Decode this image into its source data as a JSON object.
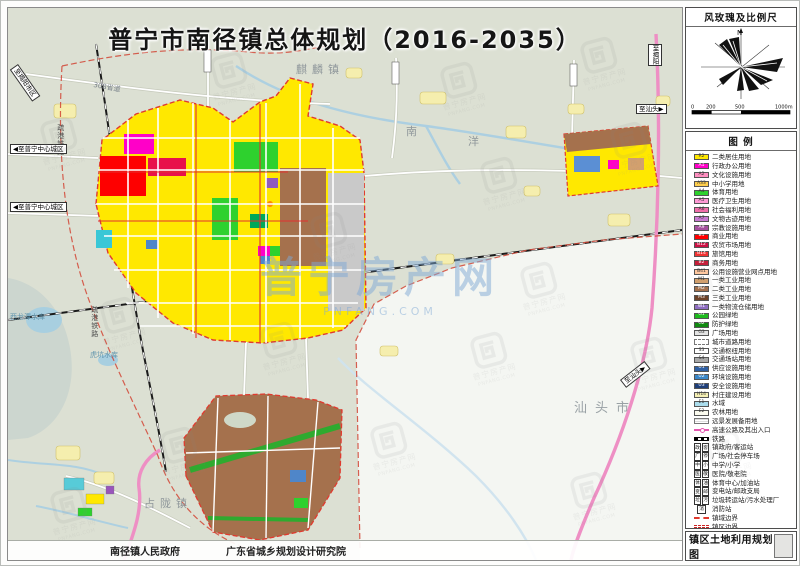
{
  "title": "普宁市南径镇总体规划（2016-2035）",
  "sheet_title": "镇区土地利用规划图",
  "credits": {
    "left": "南径镇人民政府",
    "right": "广东省城乡规划设计研究院"
  },
  "panel": {
    "windrose_title": "风玫瑰及比例尺",
    "north_label": "N",
    "scale_labels": [
      "0",
      "200",
      "500",
      "1000m"
    ],
    "legend_title": "图  例"
  },
  "legend": {
    "items": [
      {
        "label": "二类居住用地",
        "type": "fill",
        "color": "#ffe800",
        "code": "R2"
      },
      {
        "label": "行政办公用地",
        "type": "fill",
        "color": "#ff00c8",
        "code": "A1"
      },
      {
        "label": "文化设施用地",
        "type": "fill",
        "color": "#ff8fc0",
        "code": "A2"
      },
      {
        "label": "中小学用地",
        "type": "fill",
        "color": "#ffcf4d",
        "code": "A33"
      },
      {
        "label": "体育用地",
        "type": "fill",
        "color": "#2ed12e",
        "code": "A4"
      },
      {
        "label": "医疗卫生用地",
        "type": "fill",
        "color": "#ff9ad5",
        "code": "A5"
      },
      {
        "label": "社会福利用地",
        "type": "fill",
        "color": "#f06eaa",
        "code": "A6"
      },
      {
        "label": "文物古迹用地",
        "type": "fill",
        "color": "#c879d2",
        "code": "A7"
      },
      {
        "label": "宗教设施用地",
        "type": "fill",
        "color": "#a4509e",
        "code": "A9"
      },
      {
        "label": "商业用地",
        "type": "fill",
        "color": "#ff0000",
        "code": "B1"
      },
      {
        "label": "农贸市场用地",
        "type": "fill",
        "color": "#cc1144",
        "code": "B12"
      },
      {
        "label": "旅馆用地",
        "type": "fill",
        "color": "#f03333",
        "code": "B14"
      },
      {
        "label": "商务用地",
        "type": "fill",
        "color": "#c41f3a",
        "code": "B2"
      },
      {
        "label": "公用设施营业网点用地",
        "type": "fill",
        "color": "#ffc8a0",
        "code": "B41"
      },
      {
        "label": "一类工业用地",
        "type": "fill",
        "color": "#d2a06e",
        "code": "M1"
      },
      {
        "label": "二类工业用地",
        "type": "fill",
        "color": "#a5714d",
        "code": "M2"
      },
      {
        "label": "三类工业用地",
        "type": "fill",
        "color": "#6e4228",
        "code": "M3"
      },
      {
        "label": "一类物流仓储用地",
        "type": "fill",
        "color": "#8f6ec2",
        "code": "W1"
      },
      {
        "label": "公园绿地",
        "type": "fill",
        "color": "#1fba1f",
        "code": "G1"
      },
      {
        "label": "防护绿地",
        "type": "fill",
        "color": "#128a12",
        "code": "G2"
      },
      {
        "label": "广场用地",
        "type": "fill",
        "color": "#e3e3e3",
        "code": "G3"
      },
      {
        "label": "城市道路用地",
        "type": "road"
      },
      {
        "label": "交通枢纽用地",
        "type": "fill",
        "color": "#ffffff",
        "code": "S3"
      },
      {
        "label": "交通场站用地",
        "type": "fill",
        "color": "#a8a8a8",
        "code": "S4"
      },
      {
        "label": "供应设施用地",
        "type": "fill",
        "color": "#2e5fa3",
        "code": "U1"
      },
      {
        "label": "环境设施用地",
        "type": "fill",
        "color": "#3a87c8",
        "code": "U2"
      },
      {
        "label": "安全设施用地",
        "type": "fill",
        "color": "#1f3f7a",
        "code": "U3"
      },
      {
        "label": "村庄建设用地",
        "type": "fill",
        "color": "#f6f0b4",
        "code": "H14"
      },
      {
        "label": "水域",
        "type": "fill",
        "color": "#aadcec",
        "code": "E1"
      },
      {
        "label": "农林用地",
        "type": "fill",
        "color": "#fbfbef",
        "code": "E2"
      },
      {
        "label": "远景发展备用地",
        "type": "reserve"
      },
      {
        "label": "高速公路及其出入口",
        "type": "exp"
      },
      {
        "label": "铁路",
        "type": "rail"
      },
      {
        "label": "镇政府/客运站",
        "type": "sym",
        "sym": [
          "政",
          "客"
        ]
      },
      {
        "label": "广场/社会停车场",
        "type": "sym",
        "sym": [
          "广",
          "停"
        ]
      },
      {
        "label": "中学/小学",
        "type": "sym",
        "sym": [
          "中",
          "小"
        ]
      },
      {
        "label": "医院/敬老院",
        "type": "sym",
        "sym": [
          "医",
          "敬"
        ]
      },
      {
        "label": "体育中心/加油站",
        "type": "sym",
        "sym": [
          "体",
          "油"
        ]
      },
      {
        "label": "变电站/邮政支局",
        "type": "sym",
        "sym": [
          "变",
          "邮"
        ]
      },
      {
        "label": "垃圾转运站/污水处理厂",
        "type": "sym",
        "sym": [
          "垃",
          "污"
        ]
      },
      {
        "label": "消防站",
        "type": "sym",
        "sym": [
          "消"
        ]
      },
      {
        "label": "镇域边界",
        "type": "bnd1"
      },
      {
        "label": "镇区边界",
        "type": "bnd2"
      }
    ]
  },
  "map": {
    "labels": [
      {
        "text": "麒麟镇",
        "x": 288,
        "y": 56,
        "cls": "town"
      },
      {
        "text": "南",
        "x": 398,
        "y": 118,
        "cls": "town"
      },
      {
        "text": "洋",
        "x": 460,
        "y": 128,
        "cls": "town"
      },
      {
        "text": "汕头市",
        "x": 566,
        "y": 394,
        "cls": "city"
      },
      {
        "text": "占陇镇",
        "x": 136,
        "y": 490,
        "cls": "town"
      },
      {
        "text": "西龙潭水库",
        "x": 2,
        "y": 306,
        "cls": "water"
      },
      {
        "text": "虎坑水库",
        "x": 82,
        "y": 344,
        "cls": "water"
      },
      {
        "text": "疏港铁路",
        "x": 48,
        "y": 116,
        "cls": "rail"
      },
      {
        "text": "疏港铁路",
        "x": 82,
        "y": 298,
        "cls": "rail"
      },
      {
        "text": "308省道",
        "x": 86,
        "y": 74,
        "cls": "road",
        "rot": 10
      },
      {
        "text": "◀至普宁中心城区",
        "x": 2,
        "y": 136,
        "cls": "tag"
      },
      {
        "text": "◀至普宁中心城区",
        "x": 2,
        "y": 194,
        "cls": "tag"
      },
      {
        "text": "至汕头▶",
        "x": 628,
        "y": 96,
        "cls": "tag"
      },
      {
        "text": "至汕头▶",
        "x": 612,
        "y": 372,
        "cls": "tag",
        "rot": -38
      },
      {
        "text": "至揭阳市区",
        "x": 10,
        "y": 56,
        "cls": "tag",
        "rot": 55
      },
      {
        "text": "至揭阳",
        "x": 640,
        "y": 36,
        "cls": "tag",
        "v": 1
      }
    ]
  },
  "watermark": {
    "logo_text": "普宁房产网",
    "url_text": "PNFANG.COM"
  }
}
